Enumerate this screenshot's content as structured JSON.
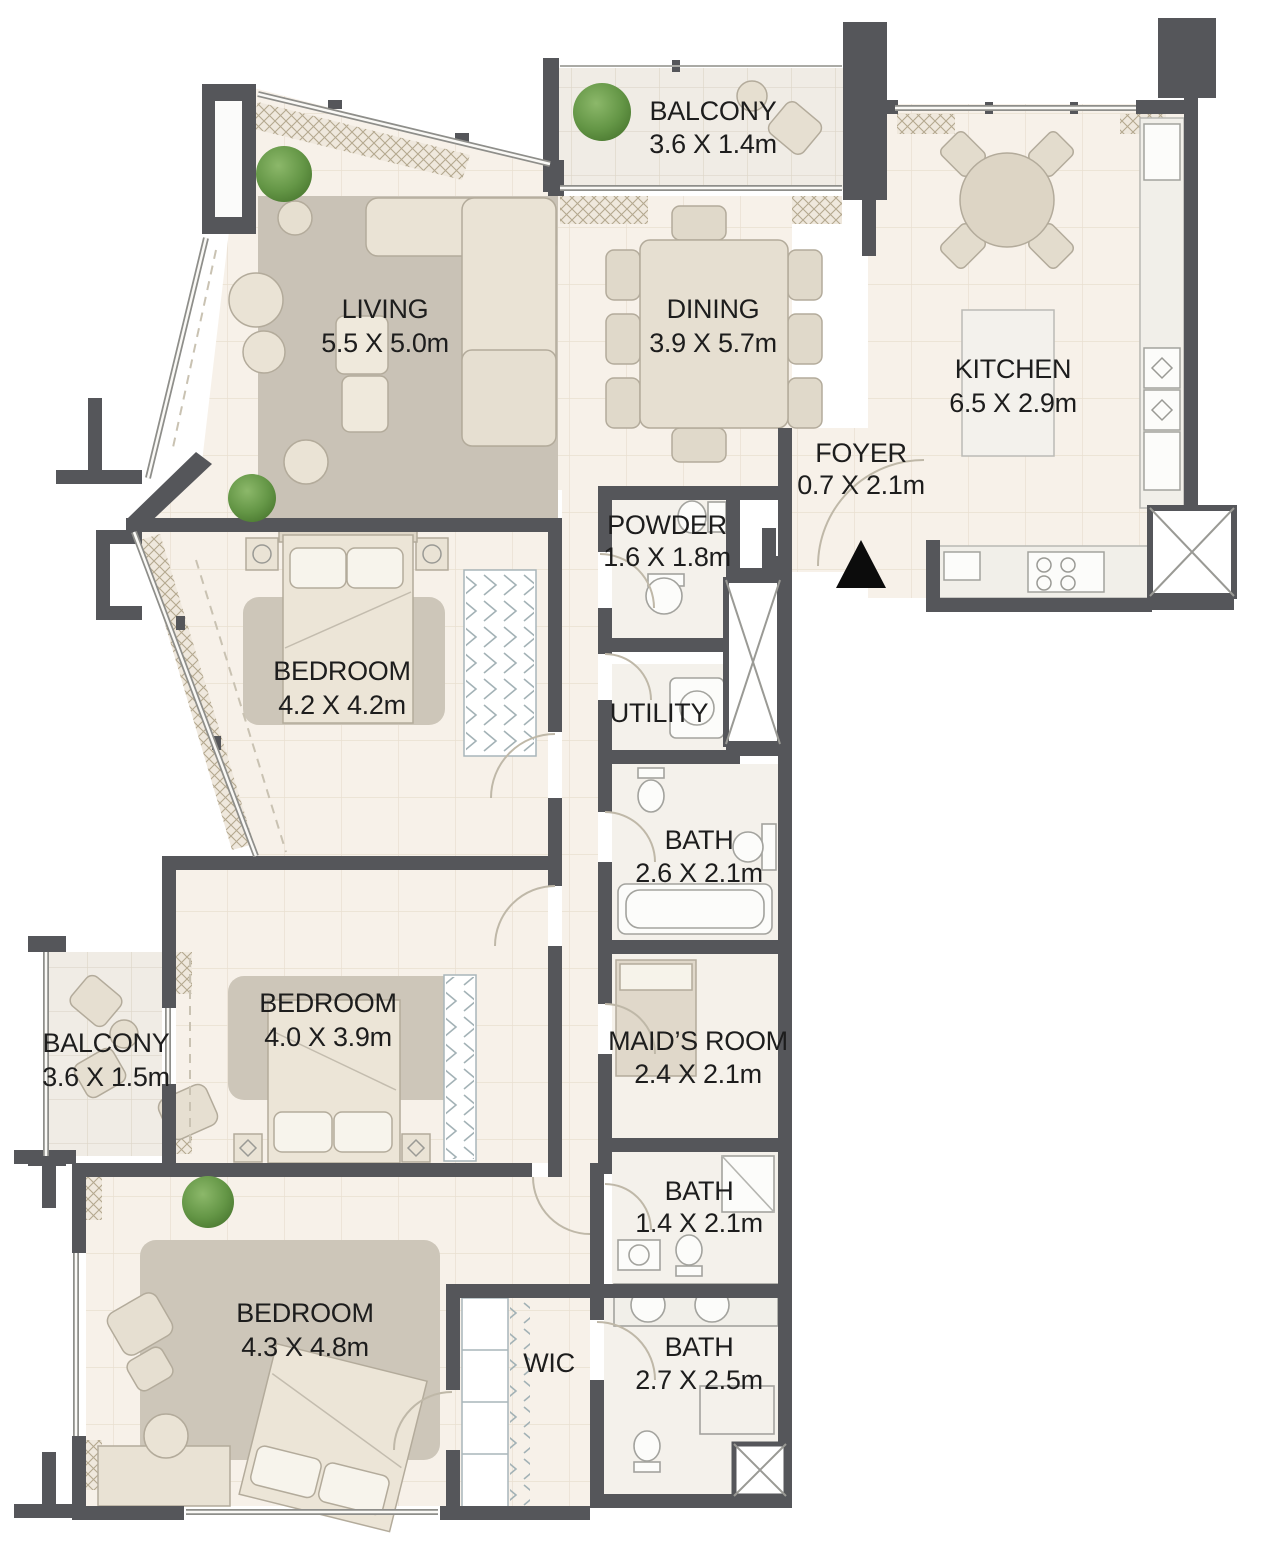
{
  "title": "Apartment Floor Plan",
  "colors": {
    "wall": "#55565a",
    "floor": "#f7f1e9",
    "balcony_floor": "#f0ece5",
    "rug": "#c9c2b6",
    "furniture": "#eae3d5",
    "fixture": "#fcfcfa",
    "plant": "#649646",
    "label_text": "#1d1d1d",
    "entrance_marker": "#0c0c0c"
  },
  "rooms": [
    {
      "id": "balcony-top",
      "name": "BALCONY",
      "dims": "3.6 X 1.4m"
    },
    {
      "id": "living",
      "name": "LIVING",
      "dims": "5.5 X 5.0m"
    },
    {
      "id": "dining",
      "name": "DINING",
      "dims": "3.9 X 5.7m"
    },
    {
      "id": "kitchen",
      "name": "KITCHEN",
      "dims": "6.5 X 2.9m"
    },
    {
      "id": "foyer",
      "name": "FOYER",
      "dims": "0.7 X 2.1m"
    },
    {
      "id": "powder",
      "name": "POWDER",
      "dims": "1.6 X 1.8m"
    },
    {
      "id": "utility",
      "name": "UTILITY",
      "dims": ""
    },
    {
      "id": "bedroom-1",
      "name": "BEDROOM",
      "dims": "4.2 X 4.2m"
    },
    {
      "id": "bath-1",
      "name": "BATH",
      "dims": "2.6 X 2.1m"
    },
    {
      "id": "balcony-left",
      "name": "BALCONY",
      "dims": "3.6 X 1.5m"
    },
    {
      "id": "bedroom-2",
      "name": "BEDROOM",
      "dims": "4.0 X 3.9m"
    },
    {
      "id": "maids-room",
      "name": "MAID’S ROOM",
      "dims": "2.4 X 2.1m"
    },
    {
      "id": "bath-2",
      "name": "BATH",
      "dims": "1.4 X 2.1m"
    },
    {
      "id": "bedroom-3",
      "name": "BEDROOM",
      "dims": "4.3 X 4.8m"
    },
    {
      "id": "wic",
      "name": "WIC",
      "dims": ""
    },
    {
      "id": "bath-3",
      "name": "BATH",
      "dims": "2.7 X 2.5m"
    }
  ]
}
